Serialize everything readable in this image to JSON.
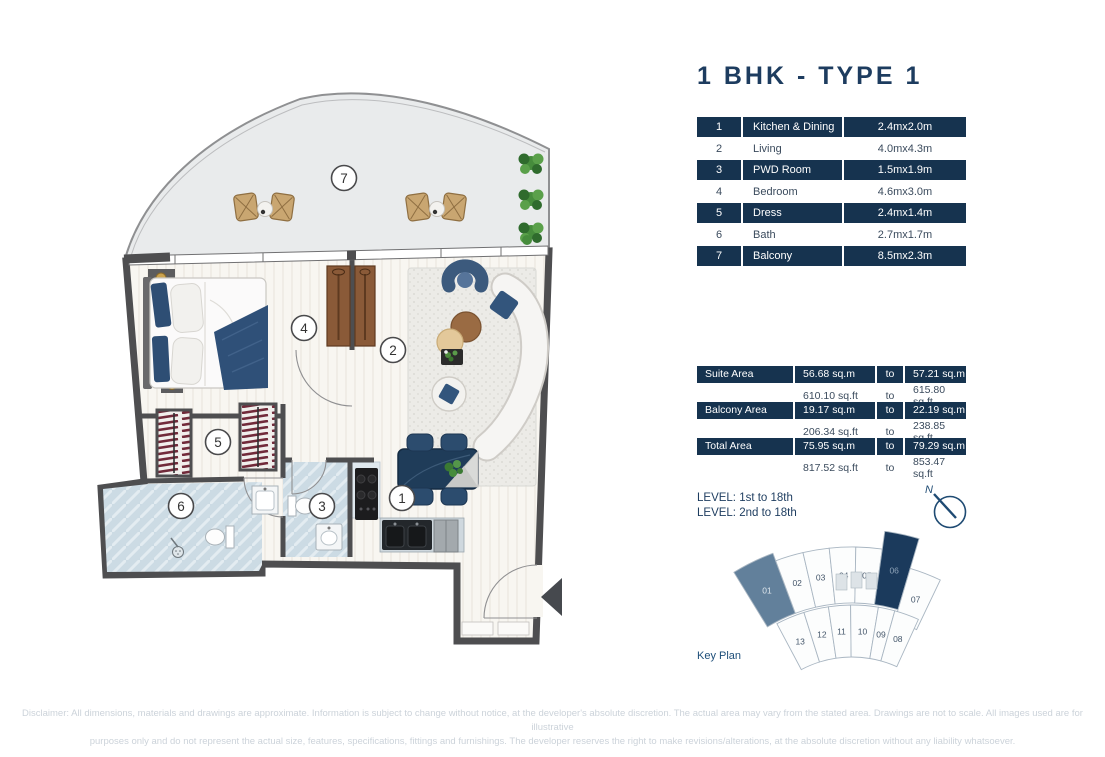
{
  "title": "1 BHK - TYPE 1",
  "colors": {
    "navy": "#16334f",
    "title_navy": "#1d3c5f",
    "row_text": "#3b4b5d",
    "disclaimer_gray": "#ccd3da",
    "caption_blue": "#1d4e79",
    "wall_gray": "#4e4e50",
    "unit01_fill": "#62809b",
    "unit06_fill": "#1b3a5c",
    "accent_blue": "#2e5078"
  },
  "room_table": {
    "rows": [
      {
        "num": "1",
        "name": "Kitchen & Dining",
        "dims": "2.4mx2.0m",
        "dark": true
      },
      {
        "num": "2",
        "name": "Living",
        "dims": "4.0mx4.3m",
        "dark": false
      },
      {
        "num": "3",
        "name": "PWD Room",
        "dims": "1.5mx1.9m",
        "dark": true
      },
      {
        "num": "4",
        "name": "Bedroom",
        "dims": "4.6mx3.0m",
        "dark": false
      },
      {
        "num": "5",
        "name": "Dress",
        "dims": "2.4mx1.4m",
        "dark": true
      },
      {
        "num": "6",
        "name": "Bath",
        "dims": "2.7mx1.7m",
        "dark": false
      },
      {
        "num": "7",
        "name": "Balcony",
        "dims": "8.5mx2.3m",
        "dark": true
      }
    ]
  },
  "area_table": {
    "rows": [
      {
        "label": "Suite Area",
        "from": "56.68 sq.m",
        "to_word": "to",
        "to": "57.21 sq.m",
        "dark": true
      },
      {
        "label": "",
        "from": "610.10 sq.ft",
        "to_word": "to",
        "to": "615.80 sq.ft",
        "dark": false
      },
      {
        "label": "Balcony Area",
        "from": "19.17 sq.m",
        "to_word": "to",
        "to": "22.19 sq.m",
        "dark": true
      },
      {
        "label": "",
        "from": "206.34 sq.ft",
        "to_word": "to",
        "to": "238.85 sq.ft",
        "dark": false
      },
      {
        "label": "Total Area",
        "from": "75.95 sq.m",
        "to_word": "to",
        "to": "79.29 sq.m",
        "dark": true
      },
      {
        "label": "",
        "from": "817.52 sq.ft",
        "to_word": "to",
        "to": "853.47 sq.ft",
        "dark": false
      }
    ]
  },
  "levels": [
    "LEVEL: 1st to 18th",
    "LEVEL: 2nd to 18th"
  ],
  "north_label": "N",
  "plan": {
    "callouts": [
      {
        "n": "1",
        "x": 402,
        "y": 498
      },
      {
        "n": "2",
        "x": 393,
        "y": 350
      },
      {
        "n": "3",
        "x": 322,
        "y": 506
      },
      {
        "n": "4",
        "x": 304,
        "y": 328
      },
      {
        "n": "5",
        "x": 218,
        "y": 442
      },
      {
        "n": "6",
        "x": 181,
        "y": 506
      },
      {
        "n": "7",
        "x": 344,
        "y": 178
      }
    ]
  },
  "key_plan": {
    "caption": "Key Plan",
    "center": {
      "x": 852,
      "y": 765
    },
    "bands": {
      "top": {
        "r0": 162,
        "r1": 218
      },
      "bottom": {
        "r0": 108,
        "r1": 160
      }
    },
    "default_fill": "#fcfdfd",
    "default_text": "#44566a",
    "stroke": "#a9b6c2",
    "units": [
      {
        "label": "01",
        "band": "top",
        "a0": -31.5,
        "a1": -20.5,
        "r1": 226,
        "fill": "#62809b",
        "text": "#dde5ec"
      },
      {
        "label": "02",
        "band": "top",
        "a0": -20.5,
        "a1": -13
      },
      {
        "label": "03",
        "band": "top",
        "a0": -13,
        "a1": -6
      },
      {
        "label": "04",
        "band": "top",
        "a0": -6,
        "a1": 1
      },
      {
        "label": "05",
        "band": "top",
        "a0": 1,
        "a1": 8
      },
      {
        "label": "06",
        "band": "top",
        "a0": 8,
        "a1": 16.5,
        "r1": 236,
        "fill": "#1b3a5c",
        "text": "#8ea3b8"
      },
      {
        "label": "07",
        "band": "top",
        "a0": 16.5,
        "a1": 25.5,
        "r0": 150,
        "r1": 205
      },
      {
        "label": "13",
        "band": "bottom",
        "a0": -28,
        "a1": -17.5
      },
      {
        "label": "12",
        "band": "bottom",
        "a0": -17.5,
        "a1": -8.5
      },
      {
        "label": "11",
        "band": "bottom",
        "a0": -8.5,
        "a1": -0.5
      },
      {
        "label": "10",
        "band": "bottom",
        "a0": -0.5,
        "a1": 9.5
      },
      {
        "label": "09",
        "band": "bottom",
        "a0": 9.5,
        "a1": 15.5
      },
      {
        "label": "08",
        "band": "bottom",
        "a0": 15.5,
        "a1": 24.5
      }
    ]
  },
  "disclaimer": [
    "Disclaimer: All dimensions, materials and drawings are approximate. Information is subject to change without notice, at the developer's absolute discretion. The actual area may vary from the stated area. Drawings are not to scale. All images used are for illustrative",
    "purposes only and do not represent the actual size, features, specifications, fittings and furnishings. The developer reserves the right to make revisions/alterations, at the absolute discretion without any liability whatsoever."
  ]
}
